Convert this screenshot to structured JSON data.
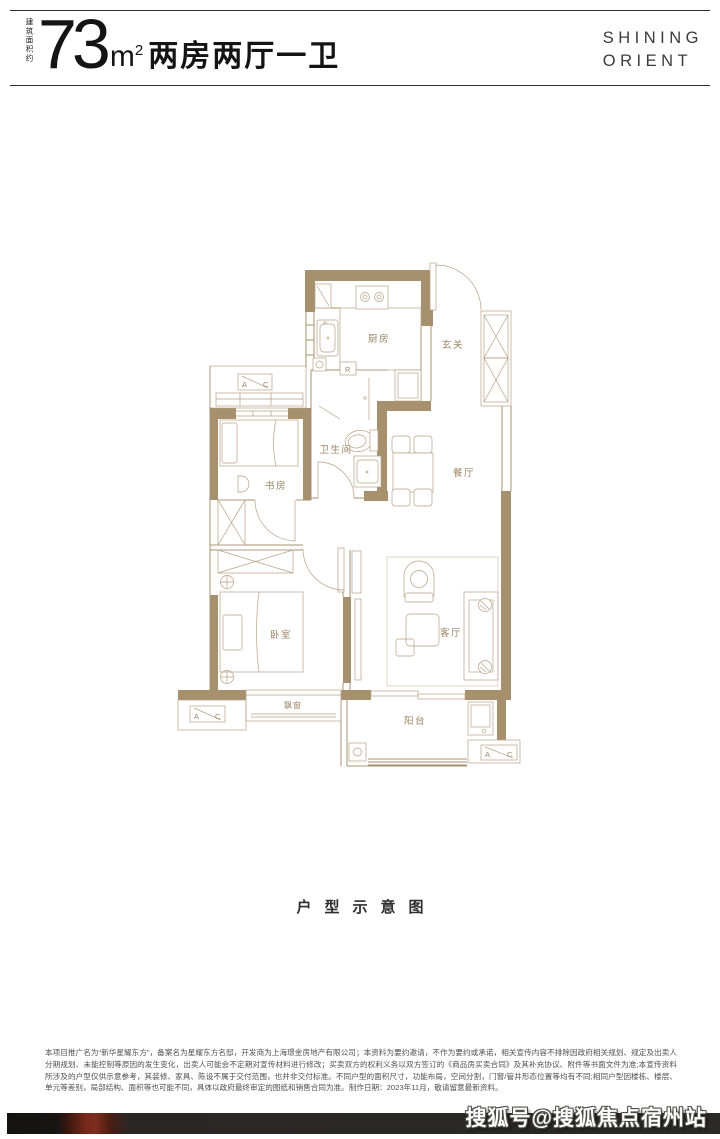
{
  "header": {
    "area_prefix": "建筑面积约",
    "area_number": "73",
    "area_unit": "m",
    "area_sup": "2",
    "layout_text": "两房两厅一卫",
    "brand_line1": "SHINING",
    "brand_line2": "ORIENT"
  },
  "floorplan": {
    "rooms": {
      "kitchen": "厨房",
      "entry": "玄关",
      "study": "书房",
      "bath": "卫生间",
      "dining": "餐厅",
      "bedroom": "卧室",
      "living": "客厅",
      "bay": "飘窗",
      "balcony": "阳台"
    },
    "markers": {
      "a": "A",
      "c": "C",
      "fridge": "R"
    }
  },
  "caption": "户型示意图",
  "disclaimer": "本项目推广名为“新华星耀东方”，备案名为星耀东方名邸，开发商为上海璟金房地产有限公司；本资料为要约邀请，不作为要约或承诺，相关宣传内容不排除因政府相关规划、规定及出卖人分期规划、未能控制等原因的发生变化，出卖人可能会不定期对宣传材料进行修改；买卖双方的权利义务以双方签订的《商品房买卖合同》及其补充协议、附件等书面文件为准;本宣传资料所涉及的户型仅供示意参考，其装修、家具、陈设不属于交付范围，也并非交付标准。不同户型的面积尺寸，功能布局，空间分割，门窗/管井形态位置等均有不同;相同户型因楼栋、楼层、单元等差别，局部结构、面积等也可能不同，具体以政府最终审定的图纸和销售合同为准。制作日期：2023年11月，敬请留意最新资料。",
  "watermark": "搜狐号@搜狐焦点宿州站"
}
